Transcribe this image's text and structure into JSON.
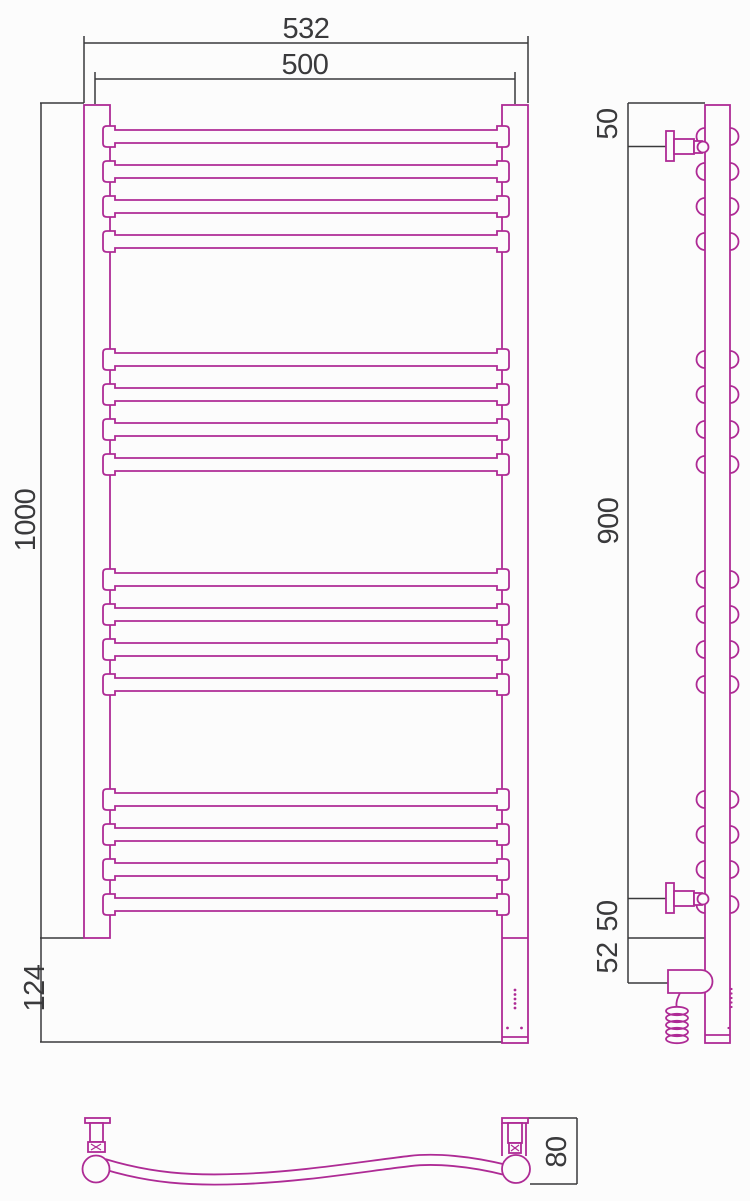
{
  "page": {
    "background": "#fcfcfc"
  },
  "drawing": {
    "line_color": "#ae2b95",
    "dimension_color": "#3a3a3c",
    "dimensions": {
      "front_overall_width": "532",
      "front_axis_width": "500",
      "front_height": "1000",
      "front_bottom_height": "124",
      "side_top_bracket_offset": "50",
      "side_bracket_span": "900",
      "side_bottom_bracket_offset": "50",
      "side_heater_offset": "52",
      "top_depth": "80"
    }
  }
}
